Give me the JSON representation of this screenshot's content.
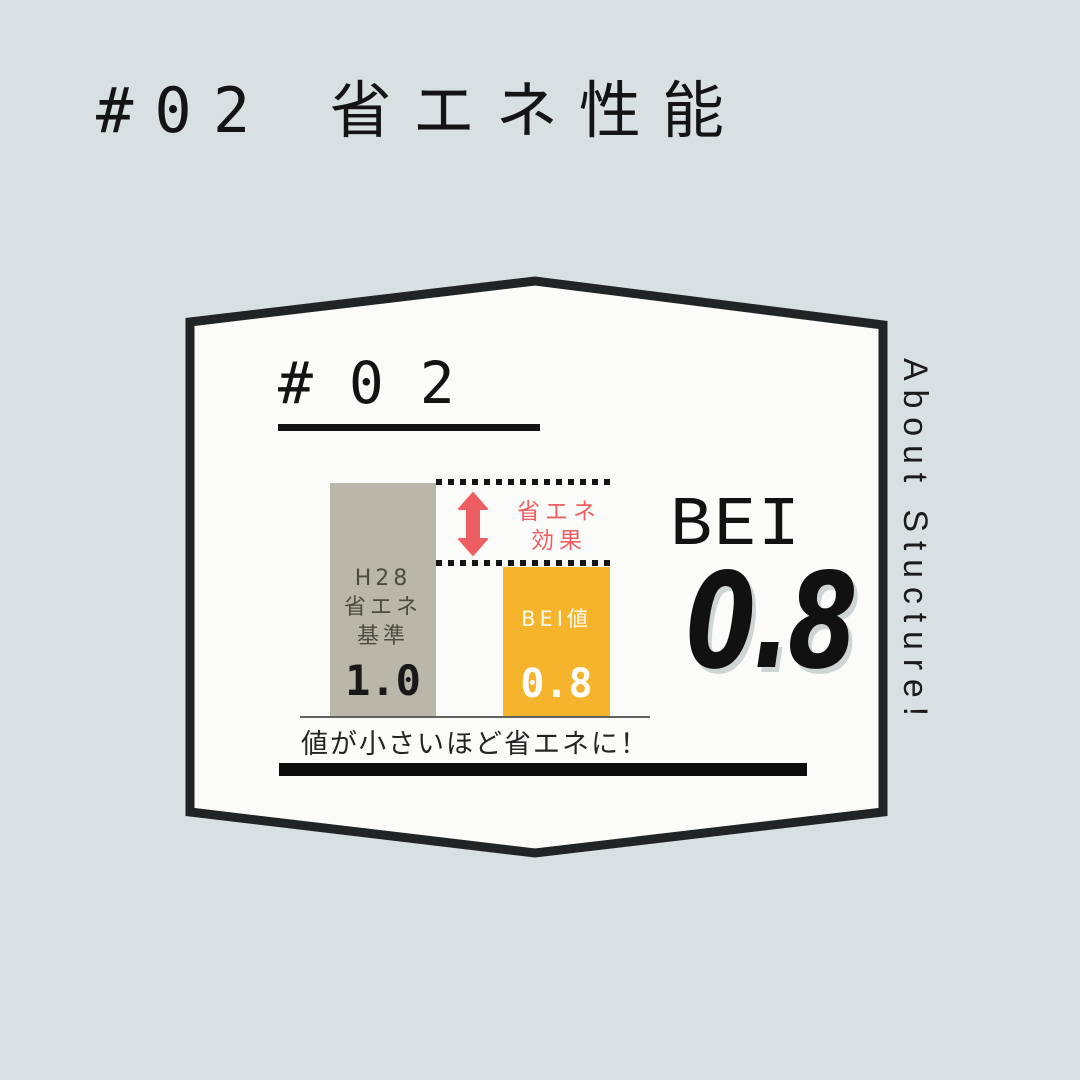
{
  "palette": {
    "background": "#d9e0e1",
    "card_bg": "#fbfcfa",
    "card_border": "#212425",
    "bar_standard_color": "#b9b7a8",
    "bar_bei_color": "#f6b42d",
    "accent_red": "#ee5f63",
    "text_dark": "#141414"
  },
  "header": {
    "title": "#02 省エネ性能"
  },
  "card": {
    "number": "#02",
    "side_label": "About Stucture!"
  },
  "result": {
    "label": "BEI",
    "value": "0.8"
  },
  "chart_data": {
    "type": "bar",
    "categories": [
      "H28省エネ基準",
      "BEI値"
    ],
    "values": [
      1.0,
      0.8
    ],
    "value_labels": [
      "1.0",
      "0.8"
    ],
    "bar_colors": [
      "#b9b7a8",
      "#f6b42d"
    ],
    "ylim": [
      0,
      1.0
    ],
    "bar1_label_lines": [
      "H28",
      "省エネ",
      "基準"
    ],
    "bar2_label": "BEI値",
    "annotation_lines": [
      "省エネ",
      "効果"
    ],
    "annotation_color": "#ee5f63",
    "caption": "値が小さいほど省エネに！",
    "grid": false,
    "legend": false
  }
}
